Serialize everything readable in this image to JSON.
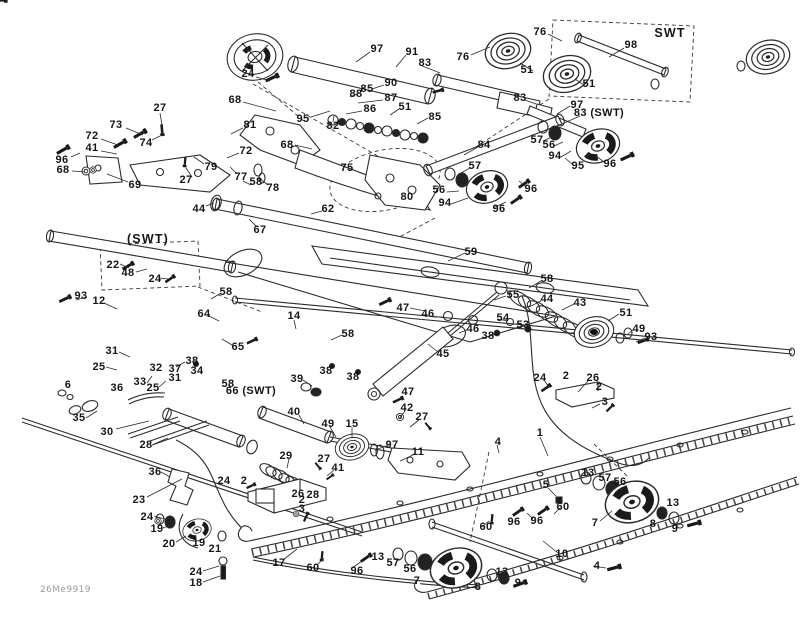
{
  "meta": {
    "code": "26Me9919"
  },
  "colors": {
    "ink": "#2b2b2b",
    "dark_fill": "#1a1a1a",
    "label_text": "#161616",
    "background": "#ffffff",
    "code_text": "#9a9a9a"
  },
  "labels_format": "[text, x, y]",
  "labels": [
    [
      "27",
      160,
      108
    ],
    [
      "24",
      248,
      74
    ],
    [
      "68",
      235,
      100
    ],
    [
      "73",
      116,
      125
    ],
    [
      "74",
      146,
      143
    ],
    [
      "72",
      92,
      136
    ],
    [
      "41",
      92,
      148
    ],
    [
      "96",
      62,
      160
    ],
    [
      "68",
      63,
      170
    ],
    [
      "69",
      135,
      185
    ],
    [
      "27",
      186,
      180
    ],
    [
      "79",
      211,
      167
    ],
    [
      "81",
      250,
      125
    ],
    [
      "72",
      246,
      151
    ],
    [
      "77",
      241,
      177
    ],
    [
      "58",
      256,
      182
    ],
    [
      "78",
      273,
      188
    ],
    [
      "44",
      199,
      209
    ],
    [
      "67",
      260,
      230
    ],
    [
      "62",
      328,
      209
    ],
    [
      "95",
      303,
      119
    ],
    [
      "82",
      333,
      126
    ],
    [
      "68",
      287,
      145
    ],
    [
      "97",
      377,
      49
    ],
    [
      "91",
      412,
      52
    ],
    [
      "83",
      425,
      63
    ],
    [
      "76",
      463,
      57
    ],
    [
      "90",
      391,
      83
    ],
    [
      "85",
      367,
      89
    ],
    [
      "88",
      356,
      94
    ],
    [
      "87",
      391,
      98
    ],
    [
      "86",
      370,
      109
    ],
    [
      "51",
      405,
      107
    ],
    [
      "85",
      435,
      117
    ],
    [
      "84",
      484,
      145
    ],
    [
      "57",
      475,
      166
    ],
    [
      "75",
      347,
      168
    ],
    [
      "80",
      407,
      197
    ],
    [
      "56",
      439,
      190
    ],
    [
      "94",
      445,
      203
    ],
    [
      "96",
      499,
      209
    ],
    [
      "59",
      471,
      252
    ],
    [
      "76",
      540,
      32
    ],
    [
      "SWT",
      670,
      33
    ],
    [
      "98",
      631,
      45
    ],
    [
      "51",
      527,
      70
    ],
    [
      "51",
      589,
      84
    ],
    [
      "83",
      520,
      98
    ],
    [
      "97",
      577,
      105
    ],
    [
      "83 (SWT)",
      599,
      113
    ],
    [
      "57",
      537,
      140
    ],
    [
      "56",
      549,
      145
    ],
    [
      "94",
      555,
      156
    ],
    [
      "95",
      578,
      166
    ],
    [
      "96",
      610,
      164
    ],
    [
      "96",
      531,
      189
    ],
    [
      "(SWT)",
      148,
      239
    ],
    [
      "22",
      113,
      265
    ],
    [
      "48",
      128,
      273
    ],
    [
      "24",
      155,
      279
    ],
    [
      "93",
      81,
      296
    ],
    [
      "12",
      99,
      301
    ],
    [
      "58",
      226,
      292
    ],
    [
      "64",
      204,
      314
    ],
    [
      "14",
      294,
      316
    ],
    [
      "65",
      238,
      347
    ],
    [
      "31",
      112,
      351
    ],
    [
      "38",
      192,
      361
    ],
    [
      "25",
      99,
      367
    ],
    [
      "32",
      156,
      368
    ],
    [
      "37",
      175,
      369
    ],
    [
      "34",
      197,
      371
    ],
    [
      "31",
      175,
      378
    ],
    [
      "33",
      140,
      382
    ],
    [
      "25",
      153,
      388
    ],
    [
      "36",
      117,
      388
    ],
    [
      "6",
      68,
      385
    ],
    [
      "58",
      228,
      384
    ],
    [
      "66 (SWT)",
      251,
      391
    ],
    [
      "39",
      297,
      379
    ],
    [
      "58",
      547,
      279
    ],
    [
      "55",
      513,
      295
    ],
    [
      "44",
      547,
      299
    ],
    [
      "47",
      403,
      308
    ],
    [
      "46",
      428,
      314
    ],
    [
      "54",
      503,
      318
    ],
    [
      "53",
      523,
      325
    ],
    [
      "46",
      473,
      329
    ],
    [
      "38",
      488,
      336
    ],
    [
      "58",
      348,
      334
    ],
    [
      "45",
      443,
      354
    ],
    [
      "38",
      326,
      371
    ],
    [
      "38",
      353,
      377
    ],
    [
      "47",
      408,
      392
    ],
    [
      "43",
      580,
      303
    ],
    [
      "51",
      626,
      313
    ],
    [
      "49",
      639,
      329
    ],
    [
      "93",
      651,
      337
    ],
    [
      "24",
      540,
      378
    ],
    [
      "2",
      566,
      376
    ],
    [
      "26",
      593,
      378
    ],
    [
      "2",
      599,
      387
    ],
    [
      "3",
      605,
      402
    ],
    [
      "35",
      79,
      418
    ],
    [
      "30",
      107,
      432
    ],
    [
      "28",
      146,
      445
    ],
    [
      "40",
      294,
      412
    ],
    [
      "49",
      328,
      424
    ],
    [
      "15",
      352,
      424
    ],
    [
      "42",
      407,
      408
    ],
    [
      "27",
      422,
      417
    ],
    [
      "97",
      392,
      445
    ],
    [
      "11",
      418,
      452
    ],
    [
      "29",
      286,
      456
    ],
    [
      "27",
      324,
      459
    ],
    [
      "41",
      338,
      468
    ],
    [
      "1",
      540,
      433
    ],
    [
      "4",
      498,
      442
    ],
    [
      "36",
      155,
      472
    ],
    [
      "23",
      139,
      500
    ],
    [
      "24",
      224,
      481
    ],
    [
      "2",
      244,
      481
    ],
    [
      "26",
      298,
      494
    ],
    [
      "28",
      313,
      495
    ],
    [
      "2",
      302,
      500
    ],
    [
      "3",
      302,
      509
    ],
    [
      "24",
      147,
      517
    ],
    [
      "19",
      157,
      529
    ],
    [
      "20",
      169,
      544
    ],
    [
      "19",
      199,
      543
    ],
    [
      "21",
      215,
      549
    ],
    [
      "17",
      279,
      563
    ],
    [
      "24",
      196,
      572
    ],
    [
      "18",
      196,
      583
    ],
    [
      "60",
      313,
      568
    ],
    [
      "96",
      357,
      571
    ],
    [
      "13",
      378,
      557
    ],
    [
      "57",
      393,
      563
    ],
    [
      "56",
      410,
      569
    ],
    [
      "7",
      417,
      581
    ],
    [
      "8",
      478,
      587
    ],
    [
      "13",
      502,
      572
    ],
    [
      "9",
      518,
      583
    ],
    [
      "10",
      562,
      554
    ],
    [
      "4",
      597,
      566
    ],
    [
      "5",
      546,
      485
    ],
    [
      "60",
      486,
      527
    ],
    [
      "96",
      514,
      522
    ],
    [
      "96",
      537,
      521
    ],
    [
      "60",
      563,
      507
    ],
    [
      "13",
      588,
      473
    ],
    [
      "57",
      605,
      478
    ],
    [
      "56",
      620,
      482
    ],
    [
      "7",
      595,
      523
    ],
    [
      "13",
      673,
      503
    ],
    [
      "8",
      653,
      524
    ],
    [
      "9",
      675,
      529
    ]
  ]
}
